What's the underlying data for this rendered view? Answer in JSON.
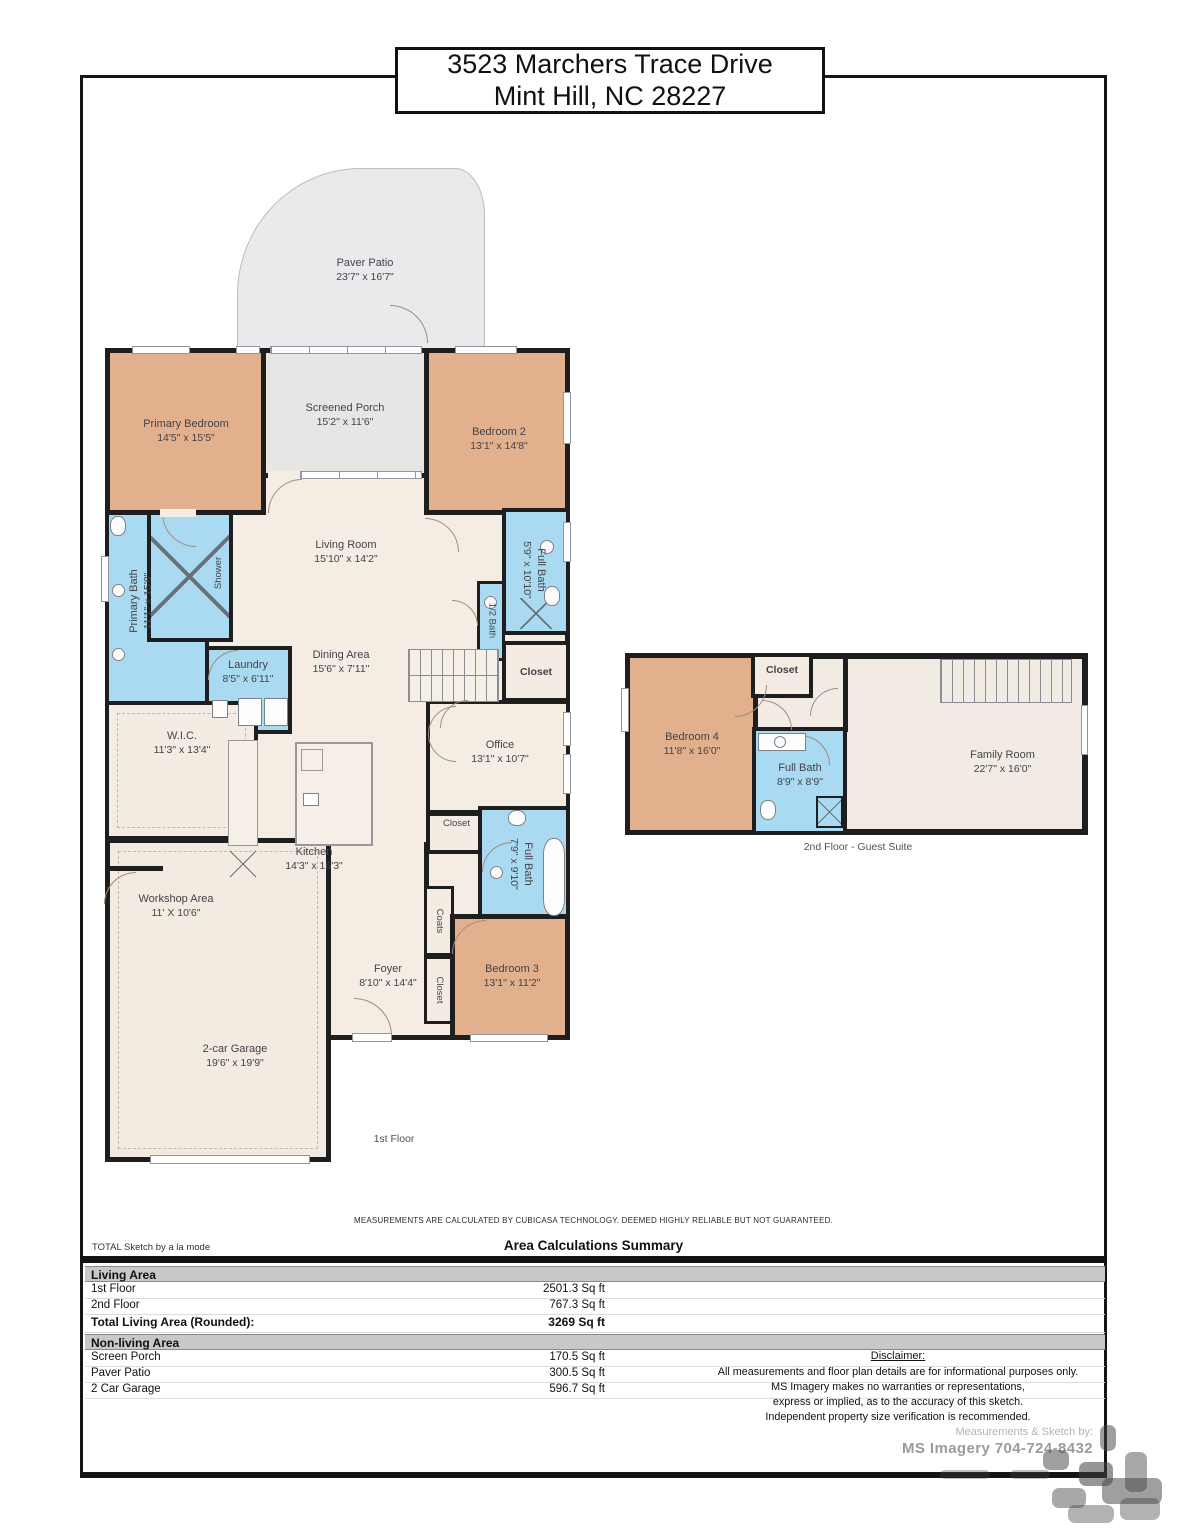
{
  "title": {
    "line1": "3523 Marchers Trace Drive",
    "line2": "Mint Hill, NC 28227"
  },
  "floor1": {
    "label": "1st Floor",
    "rooms": {
      "paver_patio": {
        "name": "Paver Patio",
        "dims": "23'7\" x 16'7\""
      },
      "screened_porch": {
        "name": "Screened Porch",
        "dims": "15'2\" x 11'6\""
      },
      "primary_bedroom": {
        "name": "Primary Bedroom",
        "dims": "14'5\" x 15'5\""
      },
      "bedroom_2": {
        "name": "Bedroom 2",
        "dims": "13'1\" x 14'8\""
      },
      "living_room": {
        "name": "Living Room",
        "dims": "15'10\" x 14'2\""
      },
      "dining_area": {
        "name": "Dining Area",
        "dims": "15'6\" x 7'11\""
      },
      "primary_bath": {
        "name": "Primary Bath",
        "dims": "11'1\" x 15'8\""
      },
      "shower": {
        "name": "Shower"
      },
      "laundry": {
        "name": "Laundry",
        "dims": "8'5\" x 6'11\""
      },
      "wic": {
        "name": "W.I.C.",
        "dims": "11'3\" x 13'4\""
      },
      "full_bath_upper": {
        "name": "Full Bath",
        "dims": "5'9\" x 10'10\""
      },
      "half_bath": {
        "name": "1/2 Bath"
      },
      "closet_hall": {
        "name": "Closet"
      },
      "office": {
        "name": "Office",
        "dims": "13'1\" x 10'7\""
      },
      "closet_office": {
        "name": "Closet"
      },
      "full_bath_lower": {
        "name": "Full Bath",
        "dims": "7'9\" x 9'10\""
      },
      "coats": {
        "name": "Coats"
      },
      "closet_foyer": {
        "name": "Closet"
      },
      "bedroom_3": {
        "name": "Bedroom 3",
        "dims": "13'1\" x 11'2\""
      },
      "kitchen": {
        "name": "Kitchen",
        "dims": "14'3\" x 16'3\""
      },
      "workshop": {
        "name": "Workshop Area",
        "dims": "11' X 10'6\""
      },
      "garage": {
        "name": "2-car Garage",
        "dims": "19'6\" x 19'9\""
      },
      "foyer": {
        "name": "Foyer",
        "dims": "8'10\" x 14'4\""
      }
    }
  },
  "floor2": {
    "label": "2nd Floor - Guest Suite",
    "rooms": {
      "bedroom_4": {
        "name": "Bedroom 4",
        "dims": "11'8\" x 16'0\""
      },
      "closet": {
        "name": "Closet"
      },
      "full_bath": {
        "name": "Full Bath",
        "dims": "8'9\" x 8'9\""
      },
      "family_room": {
        "name": "Family Room",
        "dims": "22'7\" x 16'0\""
      }
    }
  },
  "summary": {
    "note": "MEASUREMENTS ARE CALCULATED BY CUBICASA TECHNOLOGY. DEEMED HIGHLY RELIABLE BUT NOT GUARANTEED.",
    "brand": "TOTAL Sketch by a la mode",
    "heading": "Area Calculations Summary",
    "living_header": "Living Area",
    "rows_living": [
      {
        "label": "1st Floor",
        "value": "2501.3 Sq ft"
      },
      {
        "label": "2nd Floor",
        "value": "767.3 Sq ft"
      }
    ],
    "total_row": {
      "label": "Total Living Area (Rounded):",
      "value": "3269 Sq ft"
    },
    "nonliving_header": "Non-living Area",
    "rows_nonliving": [
      {
        "label": "Screen Porch",
        "value": "170.5 Sq ft"
      },
      {
        "label": "Paver Patio",
        "value": "300.5 Sq ft"
      },
      {
        "label": "2 Car Garage",
        "value": "596.7 Sq ft"
      }
    ]
  },
  "disclaimer": {
    "heading": "Disclaimer:",
    "lines": [
      "All measurements and floor plan details are for informational purposes only.",
      "MS Imagery makes no warranties or representations,",
      "express or implied, as to the accuracy of this sketch.",
      "Independent property size verification is recommended."
    ],
    "credit_label": "Measurements & Sketch by:",
    "credit_value": "MS Imagery  704-724-8432"
  },
  "colors": {
    "bedroom_tan": "#e2b08c",
    "bath_blue": "#a9daf1",
    "porch_gray": "#e7e6e4",
    "floor_cream": "#f5ece3",
    "wall_black": "#1e1e1e",
    "band_gray": "#c8c8c8"
  }
}
